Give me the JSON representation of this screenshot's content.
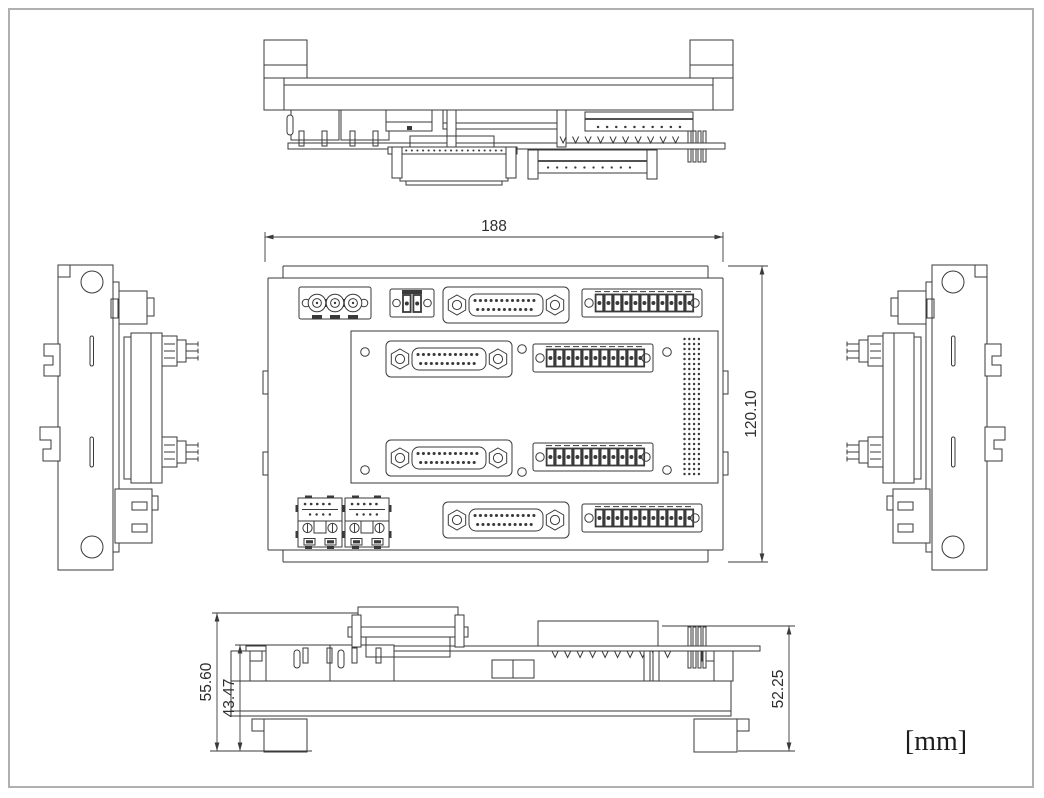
{
  "annotations": {
    "width_label": "188",
    "height_label": "120.10",
    "overall_height_label": "55.60",
    "mid_height_label": "43.47",
    "right_height_label": "52.25",
    "units_label": "[mm]"
  },
  "colors": {
    "line": "#3a3a3a",
    "frame": "#b0b0b0",
    "background": "#ffffff"
  }
}
